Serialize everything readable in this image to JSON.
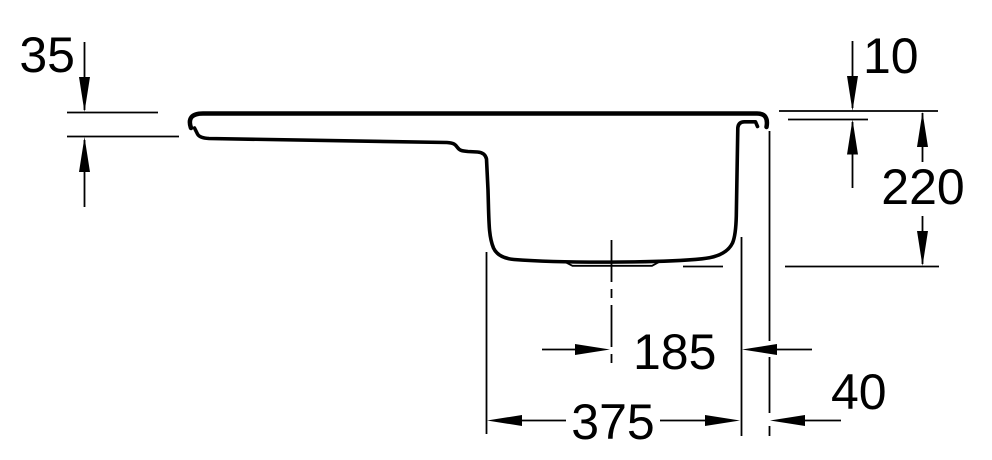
{
  "drawing": {
    "title": "sink-cross-section-technical-drawing",
    "colors": {
      "ink": "#000000",
      "background": "#ffffff"
    }
  },
  "dimensions": {
    "drainboard_edge_thickness": "35",
    "rim_profile_height": "10",
    "bowl_depth": "220",
    "drain_center_to_bowl_wall": "185",
    "bowl_width": "375",
    "bowl_to_outer_edge": "40"
  }
}
